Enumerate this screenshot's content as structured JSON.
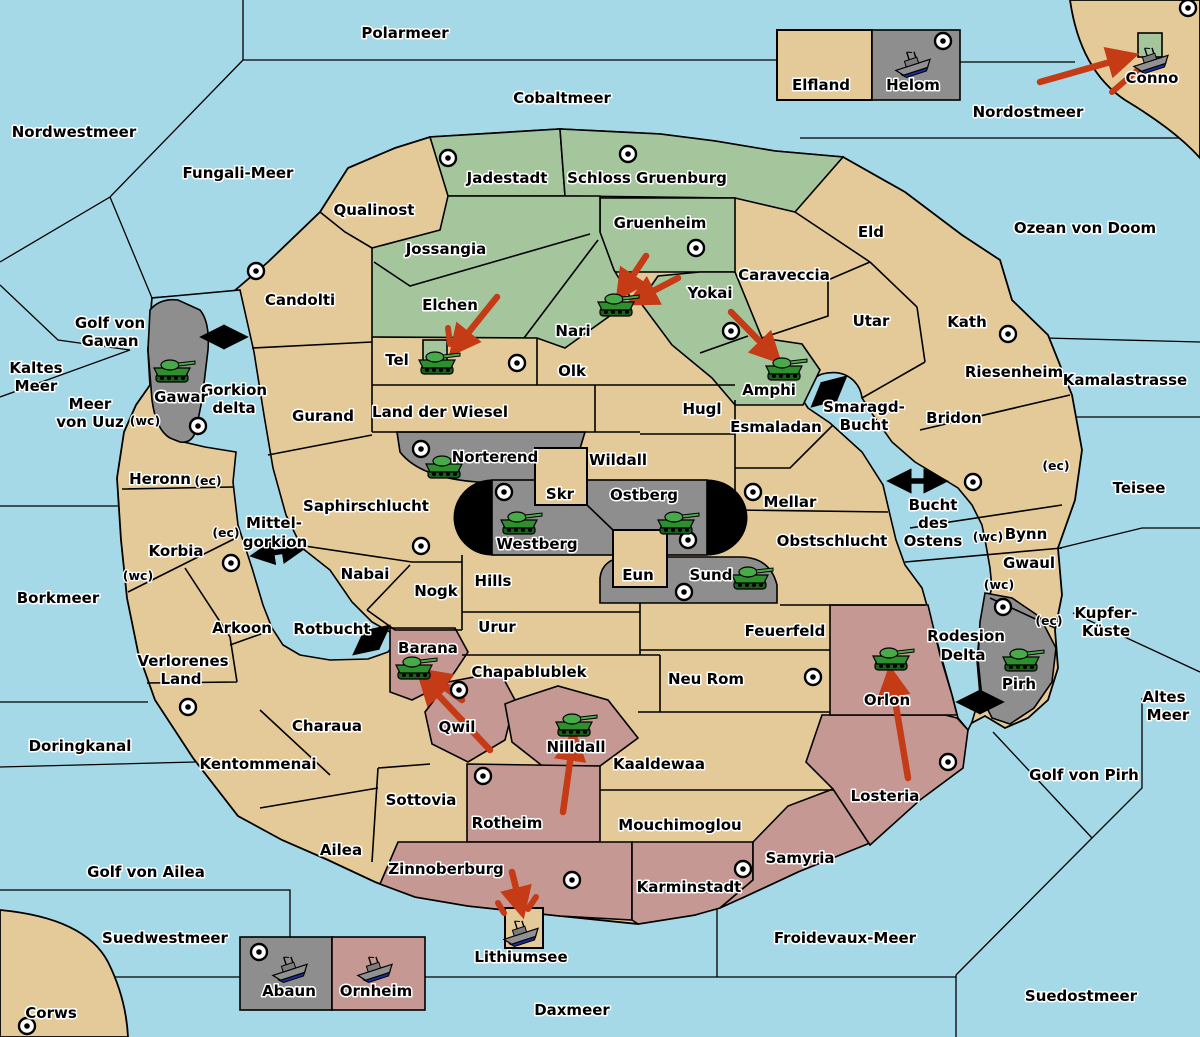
{
  "labels": {
    "polarmeer": "Polarmeer",
    "cobaltmeer": "Cobaltmeer",
    "nordostmeer": "Nordostmeer",
    "nordwestmeer": "Nordwestmeer",
    "fungali_meer": "Fungali-Meer",
    "ozean_von_doom": "Ozean von Doom",
    "kaltes_meer_1": "Kaltes",
    "kaltes_meer_2": "Meer",
    "golf_von_gawan_1": "Golf von",
    "golf_von_gawan_2": "Gawan",
    "meer_von_uuz_1": "Meer",
    "meer_von_uuz_2": "von Uuz",
    "kamalastrasse": "Kamalastrasse",
    "teisee": "Teisee",
    "borkmeer": "Borkmeer",
    "kupfer_kueste_1": "Kupfer-",
    "kupfer_kueste_2": "Küste",
    "altes_meer_1": "Altes",
    "altes_meer_2": "Meer",
    "golf_von_pirh": "Golf von Pirh",
    "doringkanal": "Doringkanal",
    "golf_von_ailea": "Golf von Ailea",
    "suedwestmeer": "Suedwestmeer",
    "froidevaux_meer": "Froidevaux-Meer",
    "suedostmeer": "Suedostmeer",
    "daxmeer": "Daxmeer",
    "corws": "Corws",
    "lithiumsee": "Lithiumsee",
    "mittel_gorkion_1": "Mittel-",
    "mittel_gorkion_2": "gorkion",
    "gorkion_delta_1": "Gorkion",
    "gorkion_delta_2": "delta",
    "smaragd_bucht_1": "Smaragd-",
    "smaragd_bucht_2": "Bucht",
    "bucht_des_ostens_1": "Bucht",
    "bucht_des_ostens_2": "des",
    "bucht_des_ostens_3": "Ostens",
    "rodesion_delta_1": "Rodesion",
    "rodesion_delta_2": "Delta",
    "rotbucht": "Rotbucht",
    "qualinost": "Qualinost",
    "candolti": "Candolti",
    "jadestadt": "Jadestadt",
    "schloss_gruenburg": "Schloss Gruenburg",
    "jossangia": "Jossangia",
    "gruenheim": "Gruenheim",
    "elchen": "Elchen",
    "nari": "Nari",
    "yokai": "Yokai",
    "amphi": "Amphi",
    "caraveccia": "Caraveccia",
    "eld": "Eld",
    "utar": "Utar",
    "kath": "Kath",
    "riesenheim": "Riesenheim",
    "bridon": "Bridon",
    "bynn": "Bynn",
    "gwaul": "Gwaul",
    "tel": "Tel",
    "olk": "Olk",
    "gurand": "Gurand",
    "land_der_wiesel": "Land der Wiesel",
    "hugl": "Hugl",
    "esmaladan": "Esmaladan",
    "wildall": "Wildall",
    "mellar": "Mellar",
    "obstschlucht": "Obstschlucht",
    "heronn": "Heronn",
    "korbia": "Korbia",
    "saphirschlucht": "Saphirschlucht",
    "nabai": "Nabai",
    "nogk": "Nogk",
    "hills": "Hills",
    "urur": "Urur",
    "feuerfeld": "Feuerfeld",
    "chapablublek": "Chapablublek",
    "neu_rom": "Neu Rom",
    "skr": "Skr",
    "eun": "Eun",
    "sund": "Sund",
    "westberg": "Westberg",
    "ostberg": "Ostberg",
    "norterend": "Norterend",
    "gawar": "Gawar",
    "pirh": "Pirh",
    "orlon": "Orlon",
    "losteria": "Losteria",
    "samyria": "Samyria",
    "karminstadt": "Karminstadt",
    "zinnoberburg": "Zinnoberburg",
    "mouchimoglou": "Mouchimoglou",
    "kaaldewaa": "Kaaldewaa",
    "nilldall": "Nilldall",
    "qwil": "Qwil",
    "barana": "Barana",
    "rotheim": "Rotheim",
    "sottovia": "Sottovia",
    "arkoon": "Arkoon",
    "verlorenes_land_1": "Verlorenes",
    "verlorenes_land_2": "Land",
    "charaua": "Charaua",
    "kentommenai": "Kentommenai",
    "ailea": "Ailea",
    "elfland": "Elfland",
    "helom": "Helom",
    "abaun": "Abaun",
    "ornheim": "Ornheim",
    "conno": "Conno"
  },
  "coast_marks": {
    "wc": "(wc)",
    "ec": "(ec)"
  },
  "units": [
    {
      "territory": "Gawar",
      "type": "army"
    },
    {
      "territory": "Tel",
      "type": "army"
    },
    {
      "territory": "Nari",
      "type": "army"
    },
    {
      "territory": "Amphi",
      "type": "army"
    },
    {
      "territory": "Norterend",
      "type": "army"
    },
    {
      "territory": "Westberg",
      "type": "army"
    },
    {
      "territory": "Ostberg",
      "type": "army"
    },
    {
      "territory": "Sund",
      "type": "army"
    },
    {
      "territory": "Barana",
      "type": "army"
    },
    {
      "territory": "Nilldall",
      "type": "army"
    },
    {
      "territory": "Orlon",
      "type": "army"
    },
    {
      "territory": "Pirh",
      "type": "army"
    },
    {
      "territory": "Helom",
      "type": "fleet"
    },
    {
      "territory": "Conno",
      "type": "fleet"
    },
    {
      "territory": "Lithiumsee",
      "type": "fleet"
    },
    {
      "territory": "Abaun",
      "type": "fleet"
    },
    {
      "territory": "Ornheim",
      "type": "fleet"
    }
  ],
  "supply_centers": [
    "Candolti",
    "Jadestadt",
    "Schloss Gruenburg",
    "Gruenheim",
    "Yokai",
    "Tel",
    "Kath",
    "Conno",
    "Helom",
    "Gawar",
    "Norterend",
    "Westberg",
    "Ostberg",
    "Sund",
    "Mellar",
    "Saphirschlucht",
    "Arkoon",
    "Qwil",
    "Rotheim",
    "Zinnoberburg",
    "Karminstadt",
    "Losteria",
    "Neu Rom",
    "Kentommenai",
    "Corws",
    "Abaun",
    "Bridon",
    "Pirh"
  ],
  "orders": [
    {
      "type": "move",
      "target": "Conno"
    },
    {
      "type": "move",
      "target": "Tel"
    },
    {
      "type": "move",
      "target": "Nari"
    },
    {
      "type": "move",
      "target": "Nari"
    },
    {
      "type": "move",
      "target": "Amphi"
    },
    {
      "type": "move",
      "target": "Barana"
    },
    {
      "type": "move",
      "target": "Barana"
    },
    {
      "type": "move",
      "target": "Nilldall"
    },
    {
      "type": "move",
      "target": "Lithiumsee"
    },
    {
      "type": "move",
      "target": "Orlon"
    }
  ],
  "colors": {
    "sea": "#a6d9e7",
    "land": "#e5ca99",
    "green_power": "#a5c59d",
    "gray_power": "#8e8e8e",
    "pink_power": "#c69893",
    "border": "#000000",
    "order_arrow": "#c43b16",
    "strait_arrow": "#000000"
  }
}
